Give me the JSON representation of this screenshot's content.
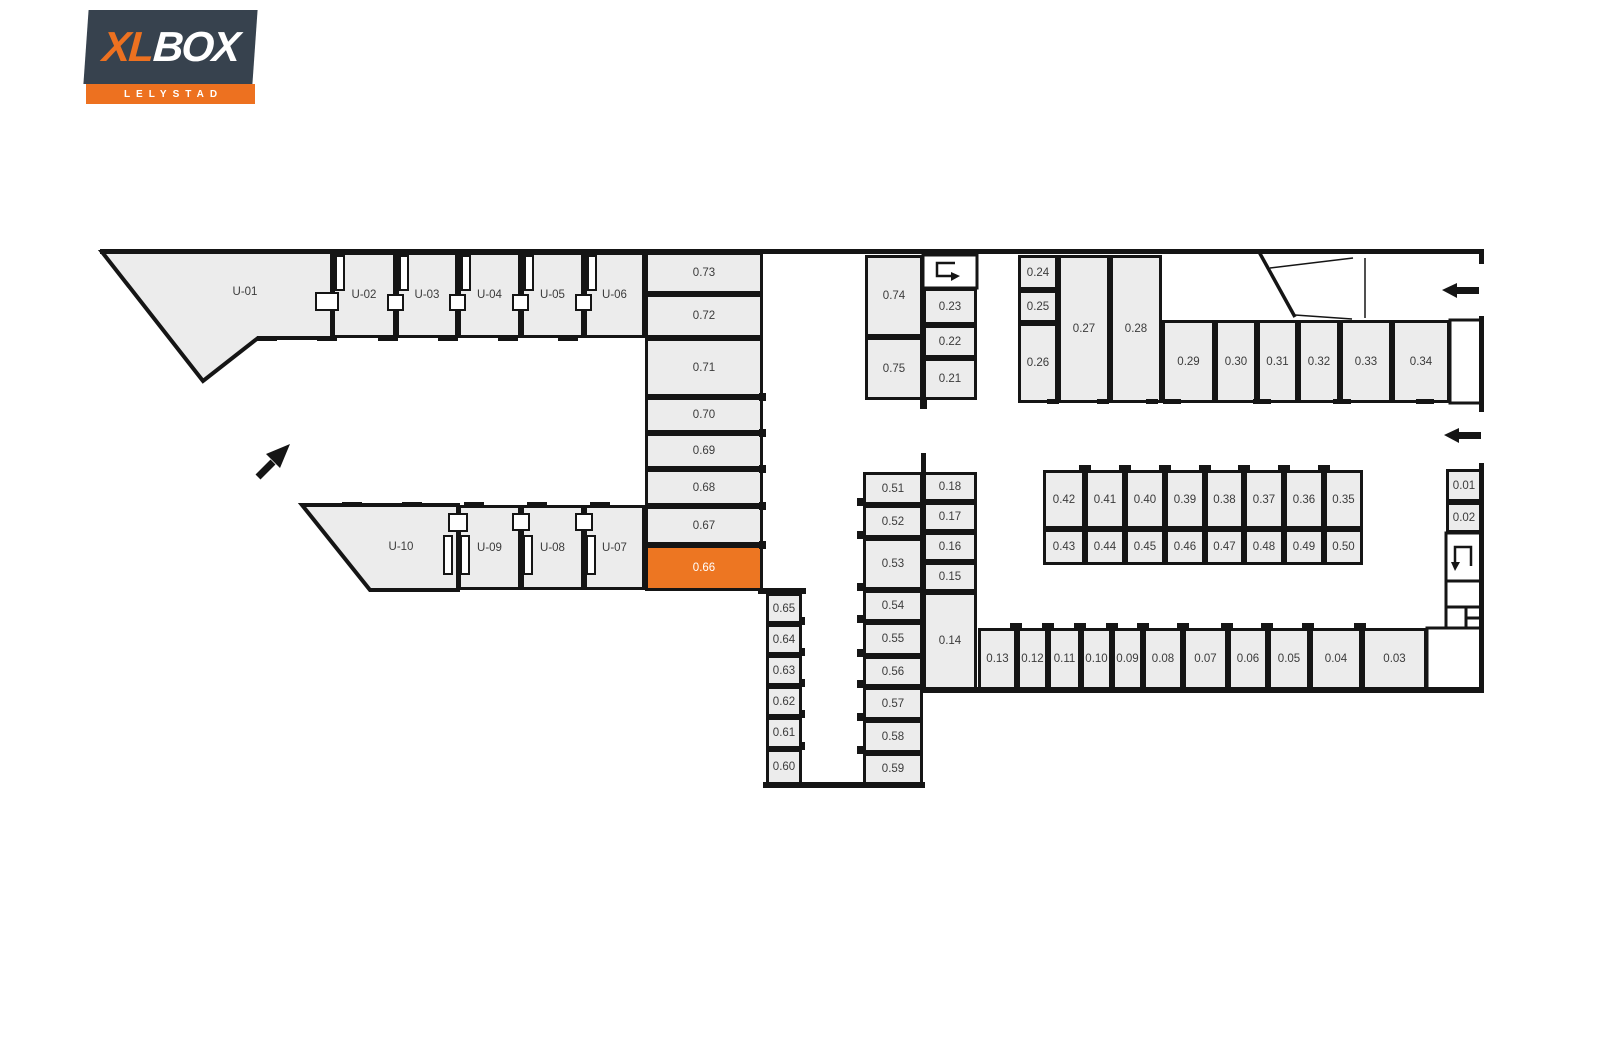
{
  "page": {
    "background": "#FFFFFF"
  },
  "logo": {
    "brand_part1": "XL",
    "brand_part2": "BOX",
    "subtitle": "LELYSTAD"
  },
  "colors": {
    "accent_orange": "#ED7622",
    "logo_background": "#37424E",
    "logo_orange": "#ED7120",
    "unit_fill": "#ECECEC",
    "wall": "#151515",
    "unit_label": "#3B3B3B",
    "selected_label": "#FFFFFF"
  },
  "selection": {
    "selected_unit": "0.66"
  },
  "icons": {
    "entrance_arrow": "arrow-up-right",
    "drive_lane_arrow_top_right": "arrow-left",
    "drive_lane_arrow_mid_right": "arrow-left",
    "walk_route_top": "u-turn-right",
    "walk_route_right": "u-turn-down"
  },
  "units": [
    {
      "label": "U-01"
    },
    {
      "label": "U-02"
    },
    {
      "label": "U-03"
    },
    {
      "label": "U-04"
    },
    {
      "label": "U-05"
    },
    {
      "label": "U-06"
    },
    {
      "label": "U-07"
    },
    {
      "label": "U-08"
    },
    {
      "label": "U-09"
    },
    {
      "label": "U-10"
    },
    {
      "label": "0.01"
    },
    {
      "label": "0.02"
    },
    {
      "label": "0.03"
    },
    {
      "label": "0.04"
    },
    {
      "label": "0.05"
    },
    {
      "label": "0.06"
    },
    {
      "label": "0.07"
    },
    {
      "label": "0.08"
    },
    {
      "label": "0.09"
    },
    {
      "label": "0.10"
    },
    {
      "label": "0.11"
    },
    {
      "label": "0.12"
    },
    {
      "label": "0.13"
    },
    {
      "label": "0.14"
    },
    {
      "label": "0.15"
    },
    {
      "label": "0.16"
    },
    {
      "label": "0.17"
    },
    {
      "label": "0.18"
    },
    {
      "label": "0.21"
    },
    {
      "label": "0.22"
    },
    {
      "label": "0.23"
    },
    {
      "label": "0.24"
    },
    {
      "label": "0.25"
    },
    {
      "label": "0.26"
    },
    {
      "label": "0.27"
    },
    {
      "label": "0.28"
    },
    {
      "label": "0.29"
    },
    {
      "label": "0.30"
    },
    {
      "label": "0.31"
    },
    {
      "label": "0.32"
    },
    {
      "label": "0.33"
    },
    {
      "label": "0.34"
    },
    {
      "label": "0.35"
    },
    {
      "label": "0.36"
    },
    {
      "label": "0.37"
    },
    {
      "label": "0.38"
    },
    {
      "label": "0.39"
    },
    {
      "label": "0.40"
    },
    {
      "label": "0.41"
    },
    {
      "label": "0.42"
    },
    {
      "label": "0.43"
    },
    {
      "label": "0.44"
    },
    {
      "label": "0.45"
    },
    {
      "label": "0.46"
    },
    {
      "label": "0.47"
    },
    {
      "label": "0.48"
    },
    {
      "label": "0.49"
    },
    {
      "label": "0.50"
    },
    {
      "label": "0.51"
    },
    {
      "label": "0.52"
    },
    {
      "label": "0.53"
    },
    {
      "label": "0.54"
    },
    {
      "label": "0.55"
    },
    {
      "label": "0.56"
    },
    {
      "label": "0.57"
    },
    {
      "label": "0.58"
    },
    {
      "label": "0.59"
    },
    {
      "label": "0.60"
    },
    {
      "label": "0.61"
    },
    {
      "label": "0.62"
    },
    {
      "label": "0.63"
    },
    {
      "label": "0.64"
    },
    {
      "label": "0.65"
    },
    {
      "label": "0.66"
    },
    {
      "label": "0.67"
    },
    {
      "label": "0.68"
    },
    {
      "label": "0.69"
    },
    {
      "label": "0.70"
    },
    {
      "label": "0.71"
    },
    {
      "label": "0.72"
    },
    {
      "label": "0.73"
    },
    {
      "label": "0.74"
    },
    {
      "label": "0.75"
    }
  ]
}
